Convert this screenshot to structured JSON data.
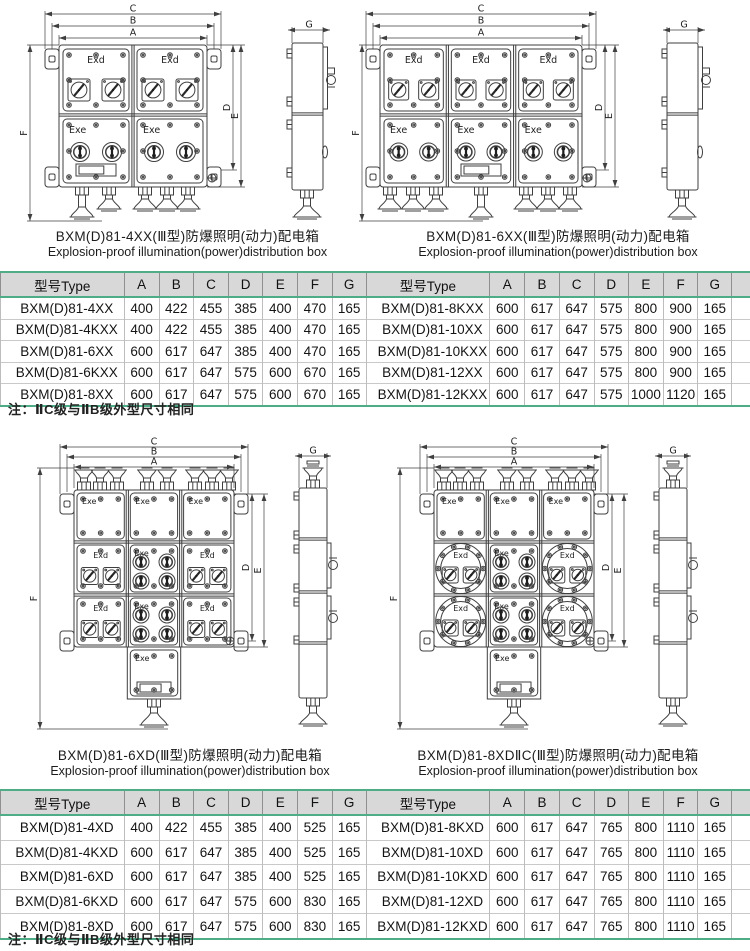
{
  "drawing_labels": {
    "exd": "Exd",
    "exe": "Exe",
    "dim_a": "A",
    "dim_b": "B",
    "dim_c": "C",
    "dim_d": "D",
    "dim_e": "E",
    "dim_f": "F",
    "dim_g": "G"
  },
  "figures": [
    {
      "caption_cn": "BXM(D)81-4XX(Ⅲ型)防爆照明(动力)配电箱",
      "caption_en": "Explosion-proof illumination(power)distribution box"
    },
    {
      "caption_cn": "BXM(D)81-6XX(Ⅲ型)防爆照明(动力)配电箱",
      "caption_en": "Explosion-proof illumination(power)distribution box"
    },
    {
      "caption_cn": "BXM(D)81-6XD(Ⅲ型)防爆照明(动力)配电箱",
      "caption_en": "Explosion-proof illumination(power)distribution box"
    },
    {
      "caption_cn": "BXM(D)81-8XDⅡC(Ⅲ型)防爆照明(动力)配电箱",
      "caption_en": "Explosion-proof illumination(power)distribution box"
    }
  ],
  "tables": [
    {
      "headers": [
        "型号Type",
        "A",
        "B",
        "C",
        "D",
        "E",
        "F",
        "G"
      ],
      "left_rows": [
        [
          "BXM(D)81-4XX",
          "400",
          "422",
          "455",
          "385",
          "400",
          "470",
          "165"
        ],
        [
          "BXM(D)81-4KXX",
          "400",
          "422",
          "455",
          "385",
          "400",
          "470",
          "165"
        ],
        [
          "BXM(D)81-6XX",
          "600",
          "617",
          "647",
          "385",
          "400",
          "470",
          "165"
        ],
        [
          "BXM(D)81-6KXX",
          "600",
          "617",
          "647",
          "575",
          "600",
          "670",
          "165"
        ],
        [
          "BXM(D)81-8XX",
          "600",
          "617",
          "647",
          "575",
          "600",
          "670",
          "165"
        ]
      ],
      "right_rows": [
        [
          "BXM(D)81-8KXX",
          "600",
          "617",
          "647",
          "575",
          "800",
          "900",
          "165"
        ],
        [
          "BXM(D)81-10XX",
          "600",
          "617",
          "647",
          "575",
          "800",
          "900",
          "165"
        ],
        [
          "BXM(D)81-10KXX",
          "600",
          "617",
          "647",
          "575",
          "800",
          "900",
          "165"
        ],
        [
          "BXM(D)81-12XX",
          "600",
          "617",
          "647",
          "575",
          "800",
          "900",
          "165"
        ],
        [
          "BXM(D)81-12KXX",
          "600",
          "617",
          "647",
          "575",
          "1000",
          "1120",
          "165"
        ]
      ]
    },
    {
      "headers": [
        "型号Type",
        "A",
        "B",
        "C",
        "D",
        "E",
        "F",
        "G"
      ],
      "left_rows": [
        [
          "BXM(D)81-4XD",
          "400",
          "422",
          "455",
          "385",
          "400",
          "525",
          "165"
        ],
        [
          "BXM(D)81-4KXD",
          "600",
          "617",
          "647",
          "385",
          "400",
          "525",
          "165"
        ],
        [
          "BXM(D)81-6XD",
          "600",
          "617",
          "647",
          "385",
          "400",
          "525",
          "165"
        ],
        [
          "BXM(D)81-6KXD",
          "600",
          "617",
          "647",
          "575",
          "600",
          "830",
          "165"
        ],
        [
          "BXM(D)81-8XD",
          "600",
          "617",
          "647",
          "575",
          "600",
          "830",
          "165"
        ]
      ],
      "right_rows": [
        [
          "BXM(D)81-8KXD",
          "600",
          "617",
          "647",
          "765",
          "800",
          "1110",
          "165"
        ],
        [
          "BXM(D)81-10XD",
          "600",
          "617",
          "647",
          "765",
          "800",
          "1110",
          "165"
        ],
        [
          "BXM(D)81-10KXD",
          "600",
          "617",
          "647",
          "765",
          "800",
          "1110",
          "165"
        ],
        [
          "BXM(D)81-12XD",
          "600",
          "617",
          "647",
          "765",
          "800",
          "1110",
          "165"
        ],
        [
          "BXM(D)81-12KXD",
          "600",
          "617",
          "647",
          "765",
          "800",
          "1110",
          "165"
        ]
      ]
    }
  ],
  "notes": [
    "注：ⅡC级与ⅡB级外型尺寸相同",
    "注：ⅡC级与ⅡB级外型尺寸相同"
  ],
  "colors": {
    "accent_green": "#4ead87",
    "header_bg": "#d8d8d8"
  }
}
